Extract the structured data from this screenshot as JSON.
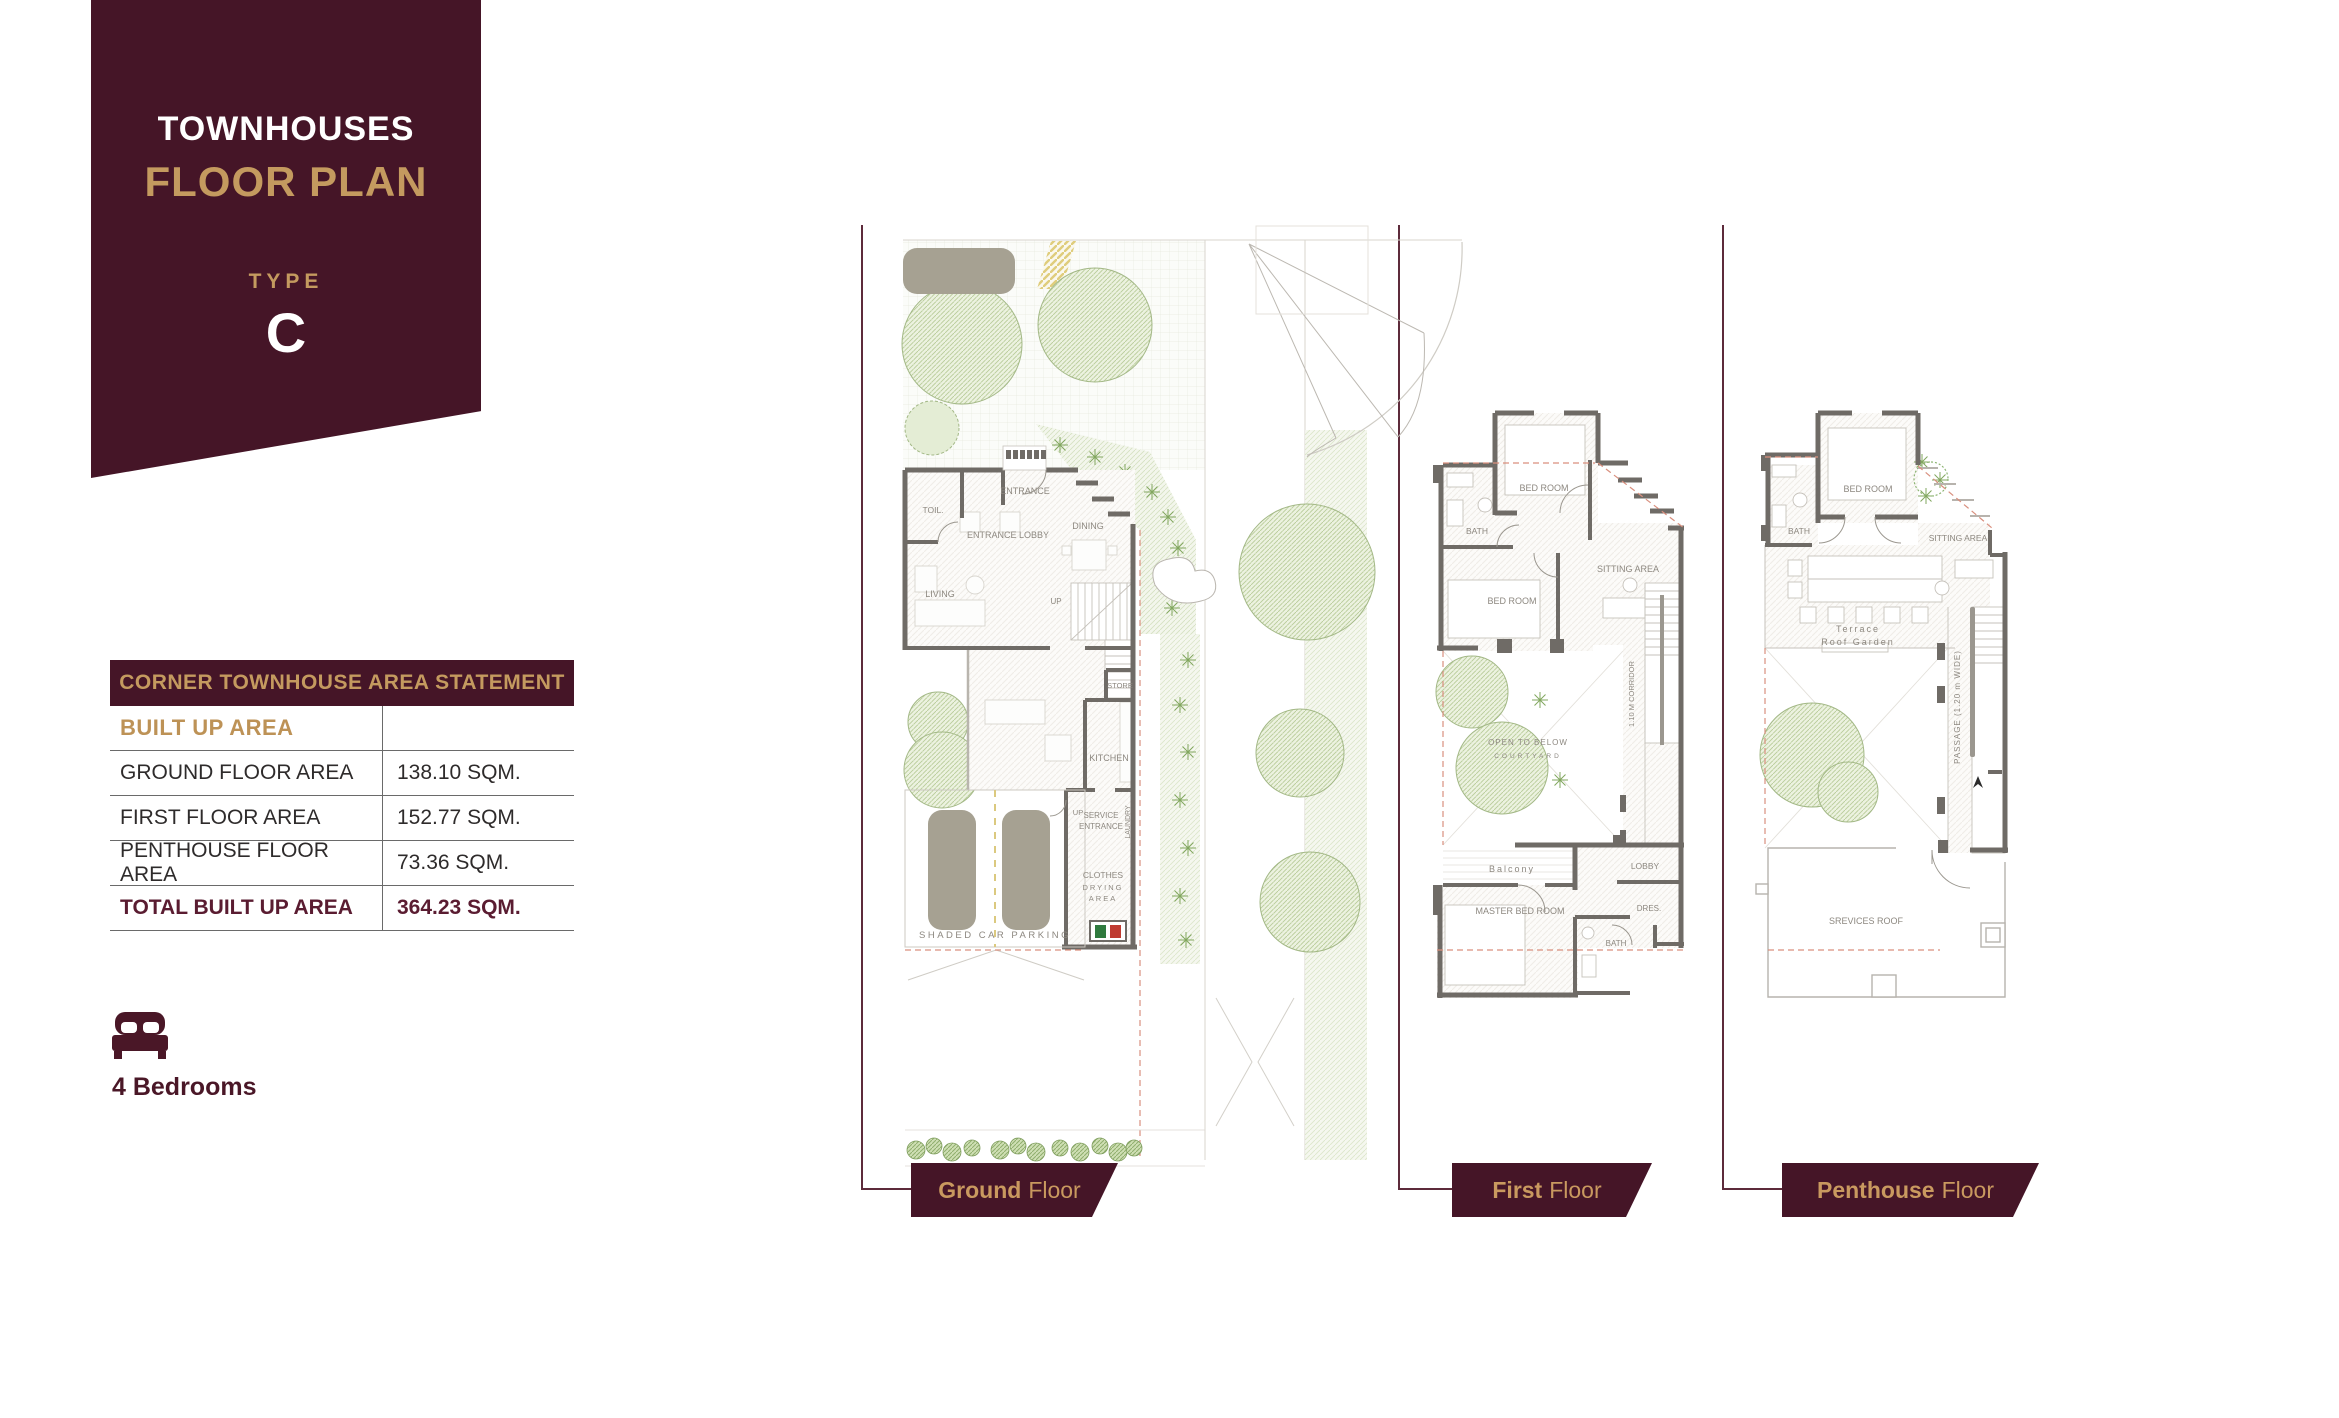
{
  "colors": {
    "maroon": "#451527",
    "gold": "#c49a5f",
    "total_text": "#5a1c31",
    "wall_gray": "#6f6b66",
    "plan_label_gray": "#8d8880",
    "vegetation_green": "#8aa768",
    "red_dash": "#d98f7e"
  },
  "banner": {
    "title": "TOWNHOUSES",
    "subtitle": "FLOOR PLAN",
    "type_label": "TYPE",
    "type_value": "C"
  },
  "area_table": {
    "header": "CORNER TOWNHOUSE AREA STATEMENT",
    "section_label": "BUILT UP AREA",
    "rows": [
      {
        "label": "GROUND FLOOR AREA",
        "value": "138.10 SQM."
      },
      {
        "label": "FIRST FLOOR AREA",
        "value": "152.77 SQM."
      },
      {
        "label": "PENTHOUSE FLOOR AREA",
        "value": "73.36 SQM."
      }
    ],
    "total": {
      "label": "TOTAL BUILT UP AREA",
      "value": "364.23 SQM."
    }
  },
  "bedrooms": {
    "icon": "bed-icon",
    "label": "4 Bedrooms"
  },
  "floors": [
    {
      "tab_bold": "Ground",
      "tab_rest": "Floor",
      "rooms": {
        "toil": "TOIL.",
        "entrance": "ENTRANCE",
        "lobby": "ENTRANCE LOBBY",
        "dining": "DINING",
        "living": "LIVING",
        "up1": "UP",
        "store": "STORE",
        "kitchen": "KITCHEN",
        "up2": "UP",
        "service1": "SERVICE",
        "service2": "ENTRANCE",
        "laundry": "LAUNDRY",
        "clothes1": "CLOTHES",
        "clothes2": "DRYING",
        "clothes3": "AREA",
        "parking": "SHADED CAR PARKING"
      }
    },
    {
      "tab_bold": "First",
      "tab_rest": "Floor",
      "rooms": {
        "bedroom1": "BED ROOM",
        "bath1": "BATH",
        "bedroom2": "BED ROOM",
        "sitting": "SITTING AREA",
        "corridor": "1.10 M CORRIDOR",
        "open1": "OPEN TO BELOW",
        "open2": "COURTYARD",
        "balcony": "Balcony",
        "master": "MASTER BED ROOM",
        "lobby": "LOBBY",
        "dress": "DRES.",
        "bath2": "BATH"
      }
    },
    {
      "tab_bold": "Penthouse",
      "tab_rest": "Floor",
      "rooms": {
        "bedroom": "BED ROOM",
        "bath": "BATH",
        "sitting": "SITTING AREA",
        "terrace1": "Terrace",
        "terrace2": "Roof Garden",
        "passage": "PASSAGE (1.20 m WIDE)",
        "services": "SREVICES ROOF"
      }
    }
  ]
}
